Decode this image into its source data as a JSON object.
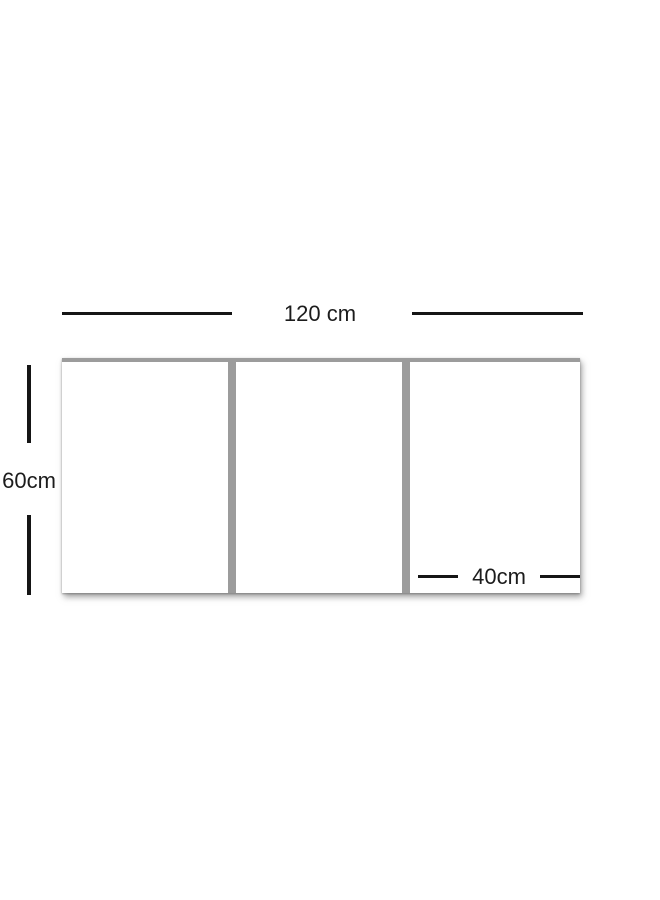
{
  "diagram": {
    "type": "product-dimension-diagram",
    "width_label": "120 cm",
    "height_label": "60cm",
    "inner_width_label": "40cm",
    "panel_count": 3,
    "colors": {
      "line": "#151515",
      "text": "#1c1c1c",
      "divider": "#9c9c9c",
      "panel_face": "#ffffff",
      "background": "#ffffff",
      "shadow": "rgba(90,90,90,0.55)"
    }
  }
}
